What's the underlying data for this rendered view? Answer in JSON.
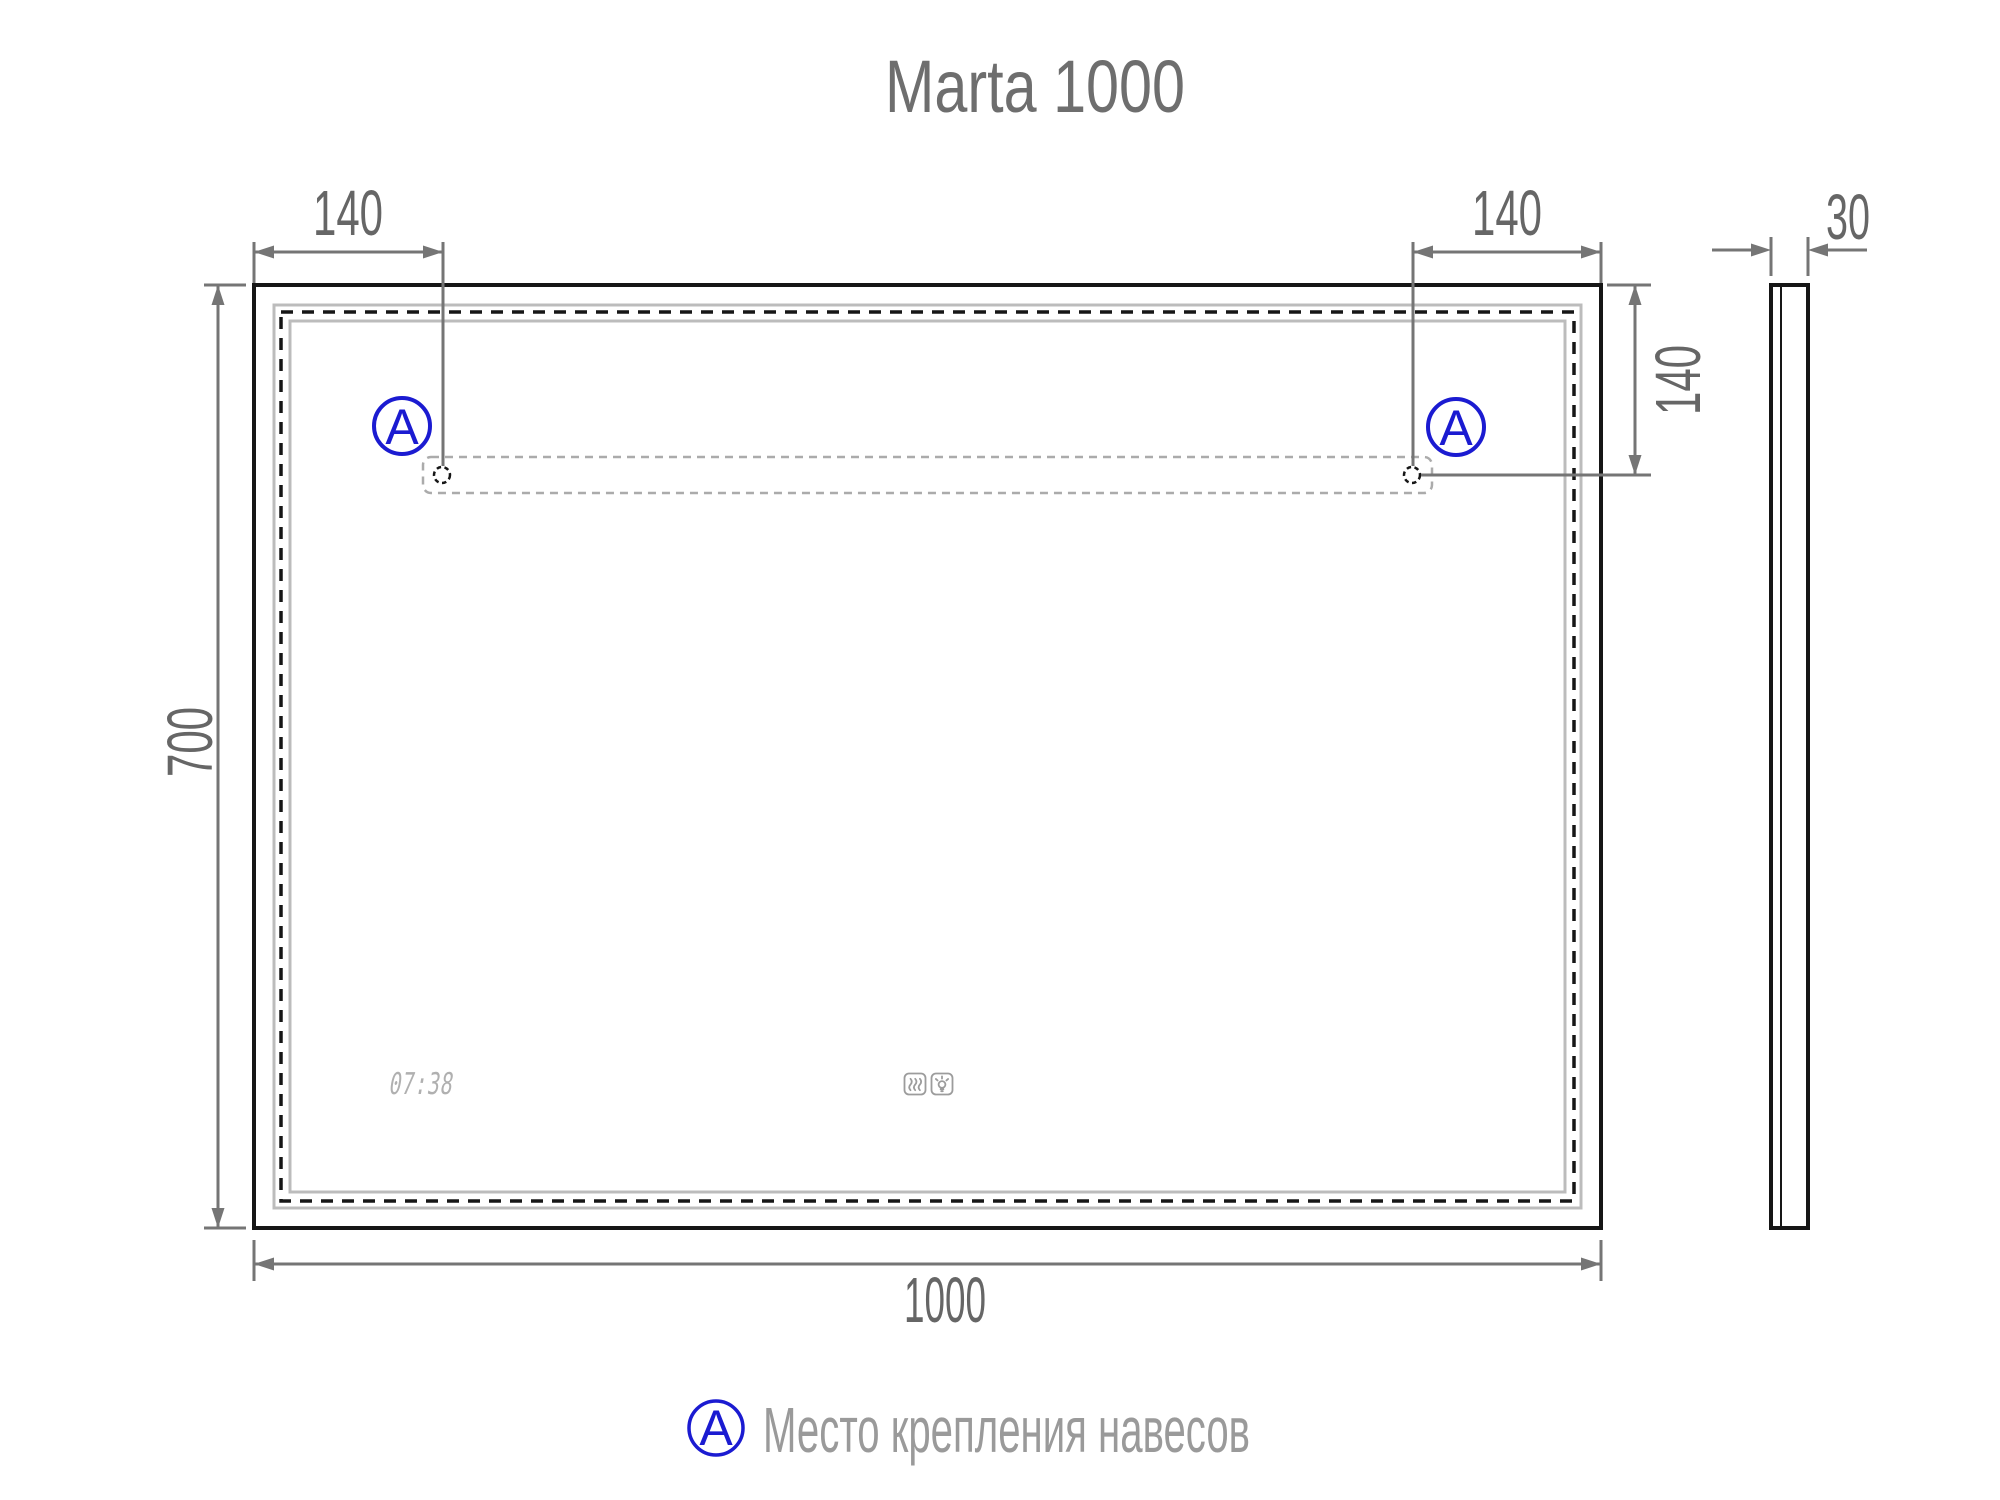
{
  "title": "Marta 1000",
  "front_view": {
    "top_left_dim": "140",
    "top_right_dim": "140",
    "right_offset_dim": "140",
    "height_dim": "700",
    "width_dim": "1000",
    "clock_time": "07:38"
  },
  "side_view": {
    "thickness_dim": "30"
  },
  "mount_marker_label": "A",
  "legend": {
    "marker_label": "A",
    "description": "Место крепления навесов"
  },
  "colors": {
    "marker_blue": "#1b1bd1",
    "drawing_ink": "#161616",
    "dimension_gray": "#757575",
    "text_gray": "#666666",
    "title_gray": "#6e6e6e",
    "legend_gray": "#9a9a9a",
    "light_gray": "#bcbcbc",
    "pale_gray": "#ababab",
    "lcd_gray": "#b0b0b0",
    "icon_gray": "#9c9c9c"
  }
}
